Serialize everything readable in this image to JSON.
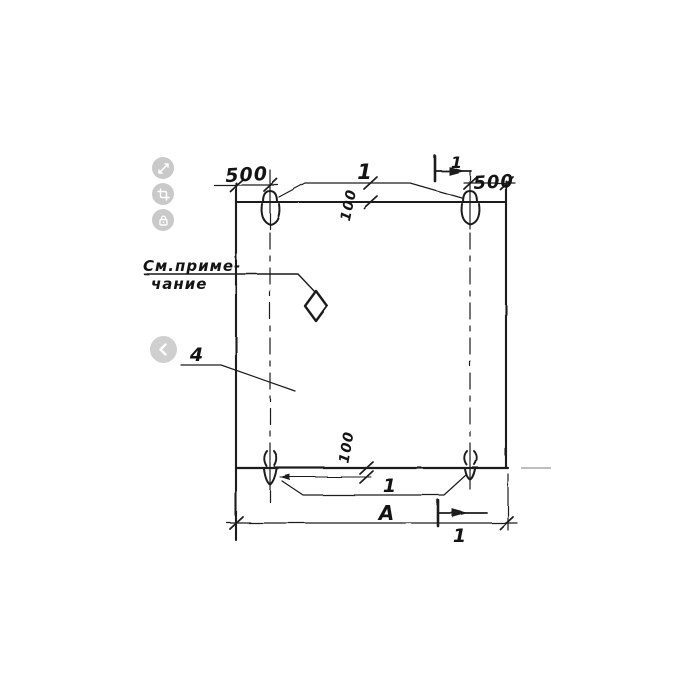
{
  "viewer": {
    "controls": [
      {
        "id": "expand",
        "icon": "expand-arrows-icon"
      },
      {
        "id": "crop",
        "icon": "crop-icon"
      },
      {
        "id": "lock",
        "icon": "lock-icon"
      }
    ],
    "prev": {
      "icon": "chevron-left-icon"
    },
    "button_bg": "#c9c9c9",
    "glyph_color": "#ffffff"
  },
  "drawing": {
    "type": "technical-drawing",
    "ink_color": "#1d1d1d",
    "faint_line_color": "#a8a8a8",
    "labels": {
      "dim_top_left": "500",
      "dim_top_right": "500",
      "top_callout": "1",
      "top_offset_dim": "100",
      "top_section_label": "1",
      "note_line1": "См.приме-",
      "note_line2": "чание",
      "part_number": "4",
      "bottom_offset_dim": "100",
      "bottom_callout": "1",
      "overall_width_dim": "A",
      "bottom_section_label": "1"
    }
  }
}
